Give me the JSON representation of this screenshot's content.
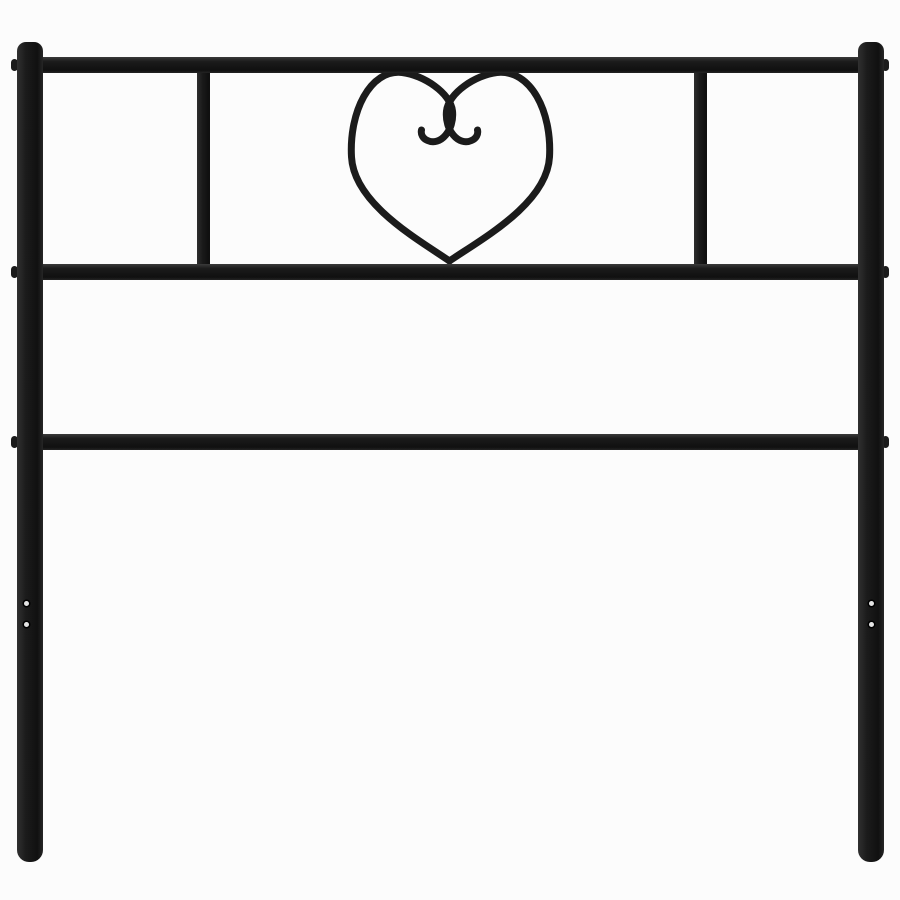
{
  "image": {
    "type": "product-photo",
    "subject": "black metal bed headboard with heart scroll ornament",
    "visible_text": ""
  },
  "colors": {
    "background": "#fcfcfc",
    "metal": "#1b1b1b",
    "metal_highlight": "#303030",
    "metal_shadow": "#101010",
    "screw_hole": "#e3e3e3"
  },
  "structure": {
    "posts": [
      "left-post",
      "right-post"
    ],
    "rails": [
      "top-rail",
      "middle-rail",
      "lower-rail"
    ],
    "dividers": [
      "left-divider",
      "right-divider"
    ],
    "ornament": "heart-scroll",
    "bolt_caps_per_post": 3,
    "screw_holes_per_leg": 2
  }
}
